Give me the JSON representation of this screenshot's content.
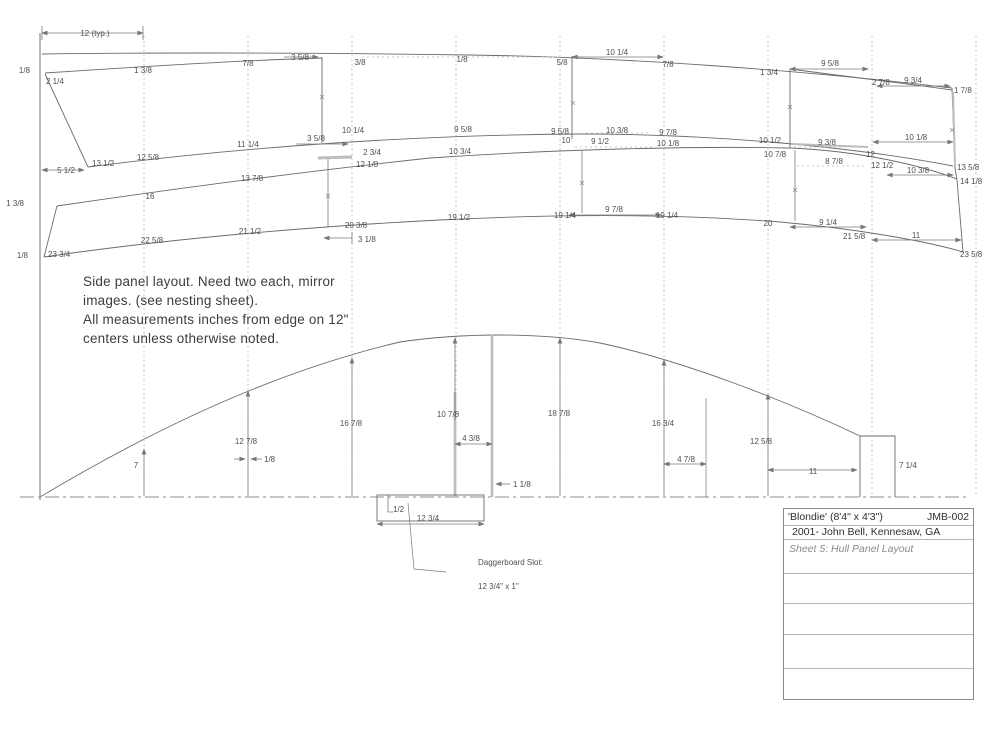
{
  "note": {
    "line1": "Side panel layout. Need two each, mirror",
    "line2": "images. (see nesting sheet).",
    "line3": "All measurements inches from edge on 12\"",
    "line4": "centers unless otherwise noted."
  },
  "title_block": {
    "title": "'Blondie' (8'4\" x 4'3\")",
    "drawing_number": "JMB-002",
    "credit": "2001- John Bell, Kennesaw, GA",
    "sheet": "Sheet 5: Hull Panel Layout"
  },
  "labels": [
    {
      "t": "12 (typ.)",
      "x": 95,
      "y": 36,
      "a": "middle"
    },
    {
      "t": "1/8",
      "x": 30,
      "y": 73,
      "a": "end"
    },
    {
      "t": "2 1/4",
      "x": 46,
      "y": 84,
      "a": "start"
    },
    {
      "t": "1 3/8",
      "x": 143,
      "y": 73,
      "a": "middle"
    },
    {
      "t": "7/8",
      "x": 248,
      "y": 66,
      "a": "middle"
    },
    {
      "t": "3 5/8",
      "x": 300,
      "y": 60,
      "a": "middle"
    },
    {
      "t": "3/8",
      "x": 360,
      "y": 65,
      "a": "middle"
    },
    {
      "t": "1/8",
      "x": 462,
      "y": 62,
      "a": "middle"
    },
    {
      "t": "5/8",
      "x": 562,
      "y": 65,
      "a": "middle"
    },
    {
      "t": "10 1/4",
      "x": 617,
      "y": 55,
      "a": "middle"
    },
    {
      "t": "7/8",
      "x": 668,
      "y": 67,
      "a": "middle"
    },
    {
      "t": "1 3/4",
      "x": 769,
      "y": 75,
      "a": "middle"
    },
    {
      "t": "9 5/8",
      "x": 830,
      "y": 66,
      "a": "middle"
    },
    {
      "t": "2 7/8",
      "x": 872,
      "y": 85,
      "a": "start"
    },
    {
      "t": "9 3/4",
      "x": 913,
      "y": 83,
      "a": "middle"
    },
    {
      "t": "1 7/8",
      "x": 954,
      "y": 93,
      "a": "start"
    },
    {
      "t": "5 1/2",
      "x": 66,
      "y": 173,
      "a": "middle"
    },
    {
      "t": "13 1/2",
      "x": 92,
      "y": 166,
      "a": "start"
    },
    {
      "t": "12 5/8",
      "x": 148,
      "y": 160,
      "a": "middle"
    },
    {
      "t": "11 1/4",
      "x": 248,
      "y": 147,
      "a": "middle"
    },
    {
      "t": "3 5/8",
      "x": 316,
      "y": 141,
      "a": "middle"
    },
    {
      "t": "10 1/4",
      "x": 353,
      "y": 133,
      "a": "middle"
    },
    {
      "t": "9 5/8",
      "x": 463,
      "y": 132,
      "a": "middle"
    },
    {
      "t": "9 5/8",
      "x": 560,
      "y": 134,
      "a": "middle"
    },
    {
      "t": "10 3/8",
      "x": 617,
      "y": 133,
      "a": "middle"
    },
    {
      "t": "9 7/8",
      "x": 668,
      "y": 135,
      "a": "middle"
    },
    {
      "t": "2 3/4",
      "x": 372,
      "y": 155,
      "a": "middle"
    },
    {
      "t": "12 1/8",
      "x": 356,
      "y": 167,
      "a": "start"
    },
    {
      "t": "10 3/4",
      "x": 460,
      "y": 154,
      "a": "middle"
    },
    {
      "t": "10",
      "x": 566,
      "y": 143,
      "a": "middle"
    },
    {
      "t": "9 1/2",
      "x": 600,
      "y": 144,
      "a": "middle"
    },
    {
      "t": "10 1/8",
      "x": 668,
      "y": 146,
      "a": "middle"
    },
    {
      "t": "10 1/2",
      "x": 770,
      "y": 143,
      "a": "middle"
    },
    {
      "t": "10 7/8",
      "x": 775,
      "y": 157,
      "a": "middle"
    },
    {
      "t": "9 3/8",
      "x": 827,
      "y": 145,
      "a": "middle"
    },
    {
      "t": "8 7/8",
      "x": 834,
      "y": 164,
      "a": "middle"
    },
    {
      "t": "12",
      "x": 866,
      "y": 157,
      "a": "start"
    },
    {
      "t": "12 1/2",
      "x": 871,
      "y": 168,
      "a": "start"
    },
    {
      "t": "10 1/8",
      "x": 916,
      "y": 140,
      "a": "middle"
    },
    {
      "t": "13 5/8",
      "x": 957,
      "y": 170,
      "a": "start"
    },
    {
      "t": "10 3/8",
      "x": 918,
      "y": 173,
      "a": "middle"
    },
    {
      "t": "14 1/8",
      "x": 960,
      "y": 184,
      "a": "start"
    },
    {
      "t": "1 3/8",
      "x": 24,
      "y": 206,
      "a": "end"
    },
    {
      "t": "16",
      "x": 150,
      "y": 199,
      "a": "middle"
    },
    {
      "t": "13 7/8",
      "x": 252,
      "y": 181,
      "a": "middle"
    },
    {
      "t": "1/8",
      "x": 28,
      "y": 258,
      "a": "end"
    },
    {
      "t": "23 3/4",
      "x": 48,
      "y": 257,
      "a": "start"
    },
    {
      "t": "22 5/8",
      "x": 152,
      "y": 243,
      "a": "middle"
    },
    {
      "t": "21 1/2",
      "x": 250,
      "y": 234,
      "a": "middle"
    },
    {
      "t": "20 3/8",
      "x": 356,
      "y": 228,
      "a": "middle"
    },
    {
      "t": "3 1/8",
      "x": 358,
      "y": 242,
      "a": "start"
    },
    {
      "t": "19 1/2",
      "x": 459,
      "y": 220,
      "a": "middle"
    },
    {
      "t": "19 1/4",
      "x": 565,
      "y": 218,
      "a": "middle"
    },
    {
      "t": "9 7/8",
      "x": 614,
      "y": 212,
      "a": "middle"
    },
    {
      "t": "19 1/4",
      "x": 667,
      "y": 218,
      "a": "middle"
    },
    {
      "t": "20",
      "x": 768,
      "y": 226,
      "a": "middle"
    },
    {
      "t": "9 1/4",
      "x": 828,
      "y": 225,
      "a": "middle"
    },
    {
      "t": "21 5/8",
      "x": 843,
      "y": 239,
      "a": "start"
    },
    {
      "t": "11",
      "x": 916,
      "y": 238,
      "a": "middle"
    },
    {
      "t": "23 5/8",
      "x": 960,
      "y": 257,
      "a": "start"
    },
    {
      "t": "7",
      "x": 136,
      "y": 468,
      "a": "middle"
    },
    {
      "t": "12 7/8",
      "x": 246,
      "y": 444,
      "a": "middle"
    },
    {
      "t": "1/8",
      "x": 264,
      "y": 462,
      "a": "start"
    },
    {
      "t": "16 7/8",
      "x": 351,
      "y": 426,
      "a": "middle"
    },
    {
      "t": "10 7/8",
      "x": 448,
      "y": 417,
      "a": "middle"
    },
    {
      "t": "4 3/8",
      "x": 471,
      "y": 441,
      "a": "middle"
    },
    {
      "t": "18 7/8",
      "x": 559,
      "y": 416,
      "a": "middle"
    },
    {
      "t": "16 3/4",
      "x": 663,
      "y": 426,
      "a": "middle"
    },
    {
      "t": "4 7/8",
      "x": 686,
      "y": 462,
      "a": "middle"
    },
    {
      "t": "12 5/8",
      "x": 761,
      "y": 444,
      "a": "middle"
    },
    {
      "t": "1 1/8",
      "x": 513,
      "y": 487,
      "a": "start"
    },
    {
      "t": "11",
      "x": 813,
      "y": 474,
      "a": "middle"
    },
    {
      "t": "7 1/4",
      "x": 899,
      "y": 468,
      "a": "start"
    },
    {
      "t": "1/2",
      "x": 393,
      "y": 512,
      "a": "start"
    },
    {
      "t": "12 3/4",
      "x": 428,
      "y": 521,
      "a": "middle"
    },
    {
      "t": "Daggerboard Slot:",
      "x": 478,
      "y": 565,
      "a": "start"
    },
    {
      "t": "12 3/4\" x 1\"",
      "x": 478,
      "y": 589,
      "a": "start"
    }
  ]
}
